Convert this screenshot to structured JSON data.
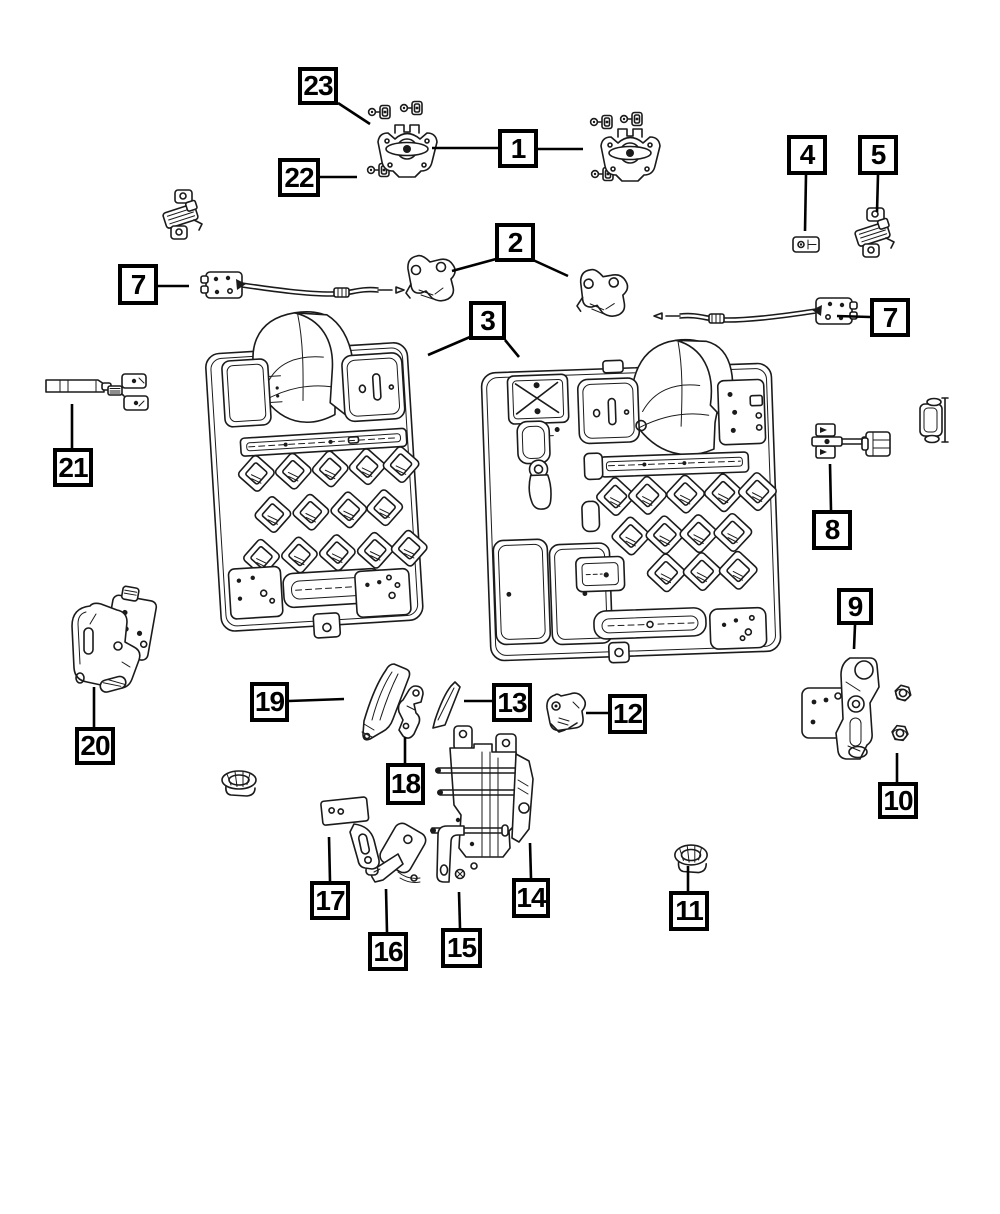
{
  "figure": {
    "kind": "exploded-parts-diagram",
    "background_color": "#ffffff",
    "line_color": "#1b1b1b",
    "callout_border_color": "#000000"
  },
  "callouts": [
    {
      "label": "1",
      "box": {
        "x": 498,
        "y": 129,
        "w": 40,
        "h": 39
      },
      "leaders": [
        {
          "x1": 498,
          "y1": 148,
          "x2": 432,
          "y2": 148
        },
        {
          "x1": 538,
          "y1": 149,
          "x2": 583,
          "y2": 149
        }
      ]
    },
    {
      "label": "2",
      "box": {
        "x": 495,
        "y": 223,
        "w": 40,
        "h": 39
      },
      "leaders": [
        {
          "x1": 496,
          "y1": 259,
          "x2": 452,
          "y2": 271
        },
        {
          "x1": 533,
          "y1": 260,
          "x2": 568,
          "y2": 276
        }
      ]
    },
    {
      "label": "3",
      "box": {
        "x": 469,
        "y": 301,
        "w": 37,
        "h": 39
      },
      "leaders": [
        {
          "x1": 470,
          "y1": 337,
          "x2": 428,
          "y2": 355
        },
        {
          "x1": 505,
          "y1": 340,
          "x2": 519,
          "y2": 357
        }
      ]
    },
    {
      "label": "4",
      "box": {
        "x": 787,
        "y": 135,
        "w": 40,
        "h": 40
      },
      "leaders": [
        {
          "x1": 806,
          "y1": 175,
          "x2": 805,
          "y2": 231
        }
      ]
    },
    {
      "label": "5",
      "box": {
        "x": 858,
        "y": 135,
        "w": 40,
        "h": 40
      },
      "leaders": [
        {
          "x1": 878,
          "y1": 175,
          "x2": 877,
          "y2": 212
        }
      ]
    },
    {
      "label": "7",
      "box": {
        "x": 118,
        "y": 264,
        "w": 40,
        "h": 41
      },
      "leaders": [
        {
          "x1": 158,
          "y1": 286,
          "x2": 189,
          "y2": 286
        }
      ]
    },
    {
      "label": "7",
      "box": {
        "x": 870,
        "y": 298,
        "w": 40,
        "h": 39
      },
      "leaders": [
        {
          "x1": 870,
          "y1": 317,
          "x2": 837,
          "y2": 316
        }
      ]
    },
    {
      "label": "8",
      "box": {
        "x": 812,
        "y": 510,
        "w": 40,
        "h": 40
      },
      "leaders": [
        {
          "x1": 831,
          "y1": 510,
          "x2": 830,
          "y2": 464
        }
      ]
    },
    {
      "label": "9",
      "box": {
        "x": 837,
        "y": 588,
        "w": 36,
        "h": 37
      },
      "leaders": [
        {
          "x1": 855,
          "y1": 625,
          "x2": 854,
          "y2": 649
        }
      ]
    },
    {
      "label": "10",
      "box": {
        "x": 878,
        "y": 782,
        "w": 40,
        "h": 37
      },
      "leaders": [
        {
          "x1": 897,
          "y1": 782,
          "x2": 897,
          "y2": 753
        }
      ]
    },
    {
      "label": "11",
      "box": {
        "x": 669,
        "y": 891,
        "w": 40,
        "h": 40
      },
      "leaders": [
        {
          "x1": 688,
          "y1": 891,
          "x2": 688,
          "y2": 866
        }
      ]
    },
    {
      "label": "12",
      "box": {
        "x": 608,
        "y": 694,
        "w": 39,
        "h": 40
      },
      "leaders": [
        {
          "x1": 608,
          "y1": 713,
          "x2": 586,
          "y2": 713
        }
      ]
    },
    {
      "label": "13",
      "box": {
        "x": 492,
        "y": 683,
        "w": 40,
        "h": 39
      },
      "leaders": [
        {
          "x1": 492,
          "y1": 701,
          "x2": 464,
          "y2": 701
        }
      ]
    },
    {
      "label": "14",
      "box": {
        "x": 512,
        "y": 878,
        "w": 38,
        "h": 40
      },
      "leaders": [
        {
          "x1": 531,
          "y1": 878,
          "x2": 530,
          "y2": 843
        }
      ]
    },
    {
      "label": "15",
      "box": {
        "x": 441,
        "y": 928,
        "w": 41,
        "h": 40
      },
      "leaders": [
        {
          "x1": 460,
          "y1": 928,
          "x2": 459,
          "y2": 892
        }
      ]
    },
    {
      "label": "16",
      "box": {
        "x": 368,
        "y": 932,
        "w": 40,
        "h": 39
      },
      "leaders": [
        {
          "x1": 387,
          "y1": 932,
          "x2": 386,
          "y2": 889
        }
      ]
    },
    {
      "label": "17",
      "box": {
        "x": 310,
        "y": 881,
        "w": 40,
        "h": 39
      },
      "leaders": [
        {
          "x1": 330,
          "y1": 881,
          "x2": 329,
          "y2": 837
        }
      ]
    },
    {
      "label": "18",
      "box": {
        "x": 386,
        "y": 763,
        "w": 39,
        "h": 42
      },
      "leaders": [
        {
          "x1": 405,
          "y1": 763,
          "x2": 405,
          "y2": 737
        }
      ]
    },
    {
      "label": "19",
      "box": {
        "x": 250,
        "y": 682,
        "w": 39,
        "h": 40
      },
      "leaders": [
        {
          "x1": 289,
          "y1": 701,
          "x2": 344,
          "y2": 699
        }
      ]
    },
    {
      "label": "20",
      "box": {
        "x": 75,
        "y": 727,
        "w": 40,
        "h": 38
      },
      "leaders": [
        {
          "x1": 94,
          "y1": 727,
          "x2": 94,
          "y2": 687
        }
      ]
    },
    {
      "label": "21",
      "box": {
        "x": 53,
        "y": 448,
        "w": 40,
        "h": 39
      },
      "leaders": [
        {
          "x1": 72,
          "y1": 448,
          "x2": 72,
          "y2": 404
        }
      ]
    },
    {
      "label": "22",
      "box": {
        "x": 278,
        "y": 158,
        "w": 42,
        "h": 39
      },
      "leaders": [
        {
          "x1": 320,
          "y1": 177,
          "x2": 357,
          "y2": 177
        }
      ]
    },
    {
      "label": "23",
      "box": {
        "x": 298,
        "y": 67,
        "w": 40,
        "h": 38
      },
      "leaders": [
        {
          "x1": 338,
          "y1": 103,
          "x2": 370,
          "y2": 124
        }
      ]
    }
  ]
}
